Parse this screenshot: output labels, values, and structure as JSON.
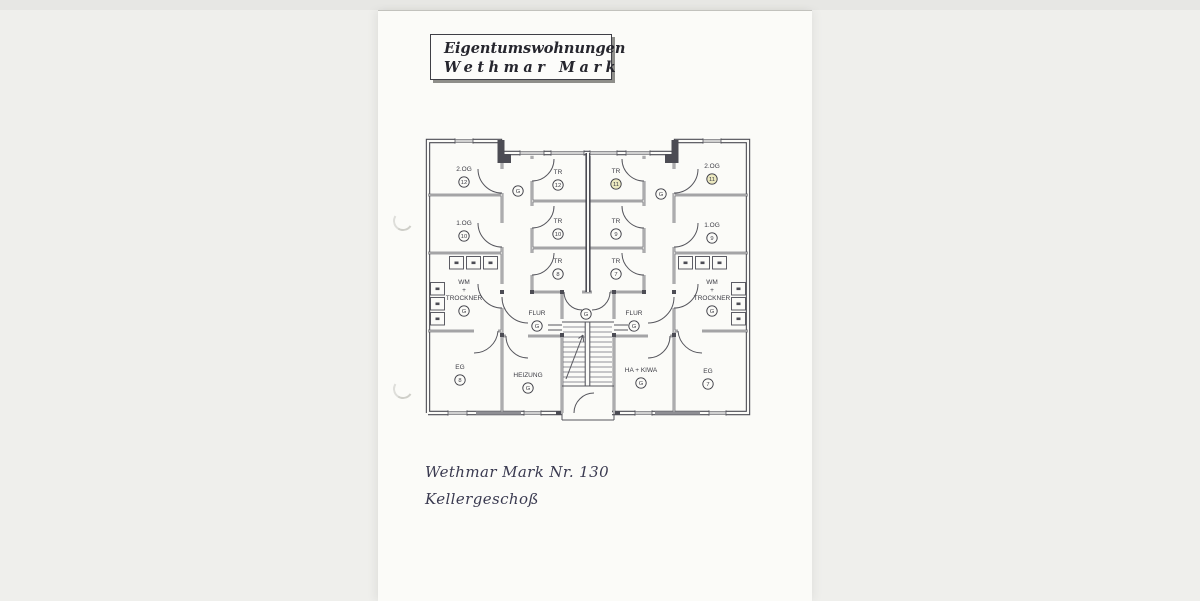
{
  "document": {
    "header": {
      "line1": "Eigentumswohnungen",
      "line2": "Wethmar Mark"
    },
    "footer": {
      "line1": "Wethmar Mark Nr. 130",
      "line2": "Kellergeschoß"
    }
  },
  "plan": {
    "highlight_color": "#ece9c0",
    "paper_color": "#fbfbf8",
    "rooms": [
      {
        "id": "2og-12",
        "lines": [
          "2.OG"
        ],
        "badge": "12",
        "x": 464,
        "y": 170
      },
      {
        "id": "tr-12",
        "lines": [
          "TR"
        ],
        "badge": "12",
        "x": 558,
        "y": 173
      },
      {
        "id": "tr-11",
        "lines": [
          "TR"
        ],
        "badge": "11",
        "x": 616,
        "y": 172,
        "highlight": true
      },
      {
        "id": "2og-11",
        "lines": [
          "2.OG"
        ],
        "badge": "11",
        "x": 712,
        "y": 167,
        "highlight": true
      },
      {
        "id": "corridor-g-left",
        "lines": [],
        "badge": "G",
        "x": 518,
        "y": 188
      },
      {
        "id": "corridor-g-right",
        "lines": [],
        "badge": "G",
        "x": 661,
        "y": 191
      },
      {
        "id": "1og-10",
        "lines": [
          "1.OG"
        ],
        "badge": "10",
        "x": 464,
        "y": 224
      },
      {
        "id": "tr-10",
        "lines": [
          "TR"
        ],
        "badge": "10",
        "x": 558,
        "y": 222
      },
      {
        "id": "tr-9",
        "lines": [
          "TR"
        ],
        "badge": "9",
        "x": 616,
        "y": 222
      },
      {
        "id": "1og-9",
        "lines": [
          "1.OG"
        ],
        "badge": "9",
        "x": 712,
        "y": 226
      },
      {
        "id": "tr-8",
        "lines": [
          "TR"
        ],
        "badge": "8",
        "x": 558,
        "y": 262
      },
      {
        "id": "tr-7",
        "lines": [
          "TR"
        ],
        "badge": "7",
        "x": 616,
        "y": 262
      },
      {
        "id": "wm-trockner-left",
        "lines": [
          "WM",
          "+",
          "TROCKNER"
        ],
        "badge": "G",
        "x": 464,
        "y": 283
      },
      {
        "id": "wm-trockner-right",
        "lines": [
          "WM",
          "+",
          "TROCKNER"
        ],
        "badge": "G",
        "x": 712,
        "y": 283
      },
      {
        "id": "flur-left",
        "lines": [
          "FLUR"
        ],
        "badge": "G",
        "x": 537,
        "y": 314
      },
      {
        "id": "stair-hall-g",
        "lines": [],
        "badge": "G",
        "x": 586,
        "y": 311
      },
      {
        "id": "flur-right",
        "lines": [
          "FLUR"
        ],
        "badge": "G",
        "x": 634,
        "y": 314
      },
      {
        "id": "eg-8",
        "lines": [
          "EG"
        ],
        "badge": "8",
        "x": 460,
        "y": 368
      },
      {
        "id": "heizung",
        "lines": [
          "HEIZUNG"
        ],
        "badge": "G",
        "x": 528,
        "y": 376
      },
      {
        "id": "ha-kiwa",
        "lines": [
          "HA + KIWA"
        ],
        "badge": "G",
        "x": 641,
        "y": 371
      },
      {
        "id": "eg-7",
        "lines": [
          "EG"
        ],
        "badge": "7",
        "x": 708,
        "y": 372
      }
    ]
  }
}
